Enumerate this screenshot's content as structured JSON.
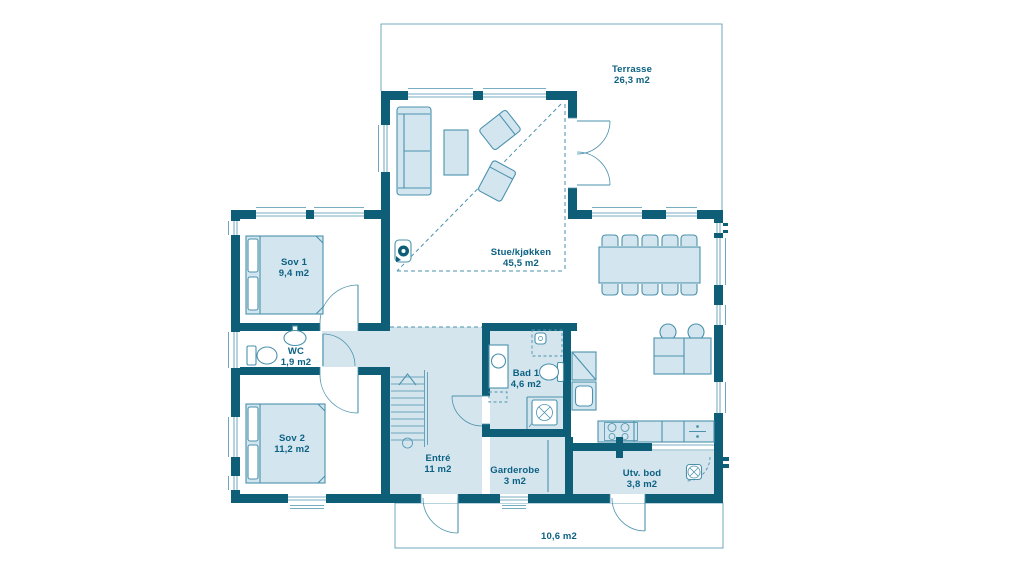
{
  "floorplan": {
    "rooms": [
      {
        "key": "terrasse",
        "name": "Terrasse",
        "area": "26,3 m2"
      },
      {
        "key": "stue_kjokken",
        "name": "Stue/kjøkken",
        "area": "45,5 m2"
      },
      {
        "key": "sov1",
        "name": "Sov 1",
        "area": "9,4 m2"
      },
      {
        "key": "wc",
        "name": "WC",
        "area": "1,9 m2"
      },
      {
        "key": "sov2",
        "name": "Sov 2",
        "area": "11,2 m2"
      },
      {
        "key": "entre",
        "name": "Entré",
        "area": "11 m2"
      },
      {
        "key": "garderobe",
        "name": "Garderobe",
        "area": "3 m2"
      },
      {
        "key": "bad1",
        "name": "Bad 1",
        "area": "4,6 m2"
      },
      {
        "key": "utv_bod",
        "name": "Utv. bod",
        "area": "3,8 m2"
      },
      {
        "key": "uteareal",
        "name": "",
        "area": "10,6 m2"
      }
    ],
    "colors": {
      "wall": "#0f5e78",
      "outline": "#4b92ad",
      "floor_light": "#d4e5ee",
      "furniture_fill": "#d3e5ee",
      "label_text": "#0c6183",
      "background": "#ffffff"
    },
    "fixtures": [
      "sofa",
      "coffee-table",
      "armchair",
      "wood-stove",
      "dining-table",
      "dining-chair",
      "kitchen-island",
      "bar-stool",
      "kitchen-counter",
      "cooktop",
      "kitchen-sink",
      "dishwasher",
      "corner-cabinet",
      "double-bed",
      "toilet",
      "washbasin",
      "vanity-sink",
      "shower",
      "washing-machine",
      "wardrobe",
      "staircase",
      "outdoor-tap"
    ]
  }
}
